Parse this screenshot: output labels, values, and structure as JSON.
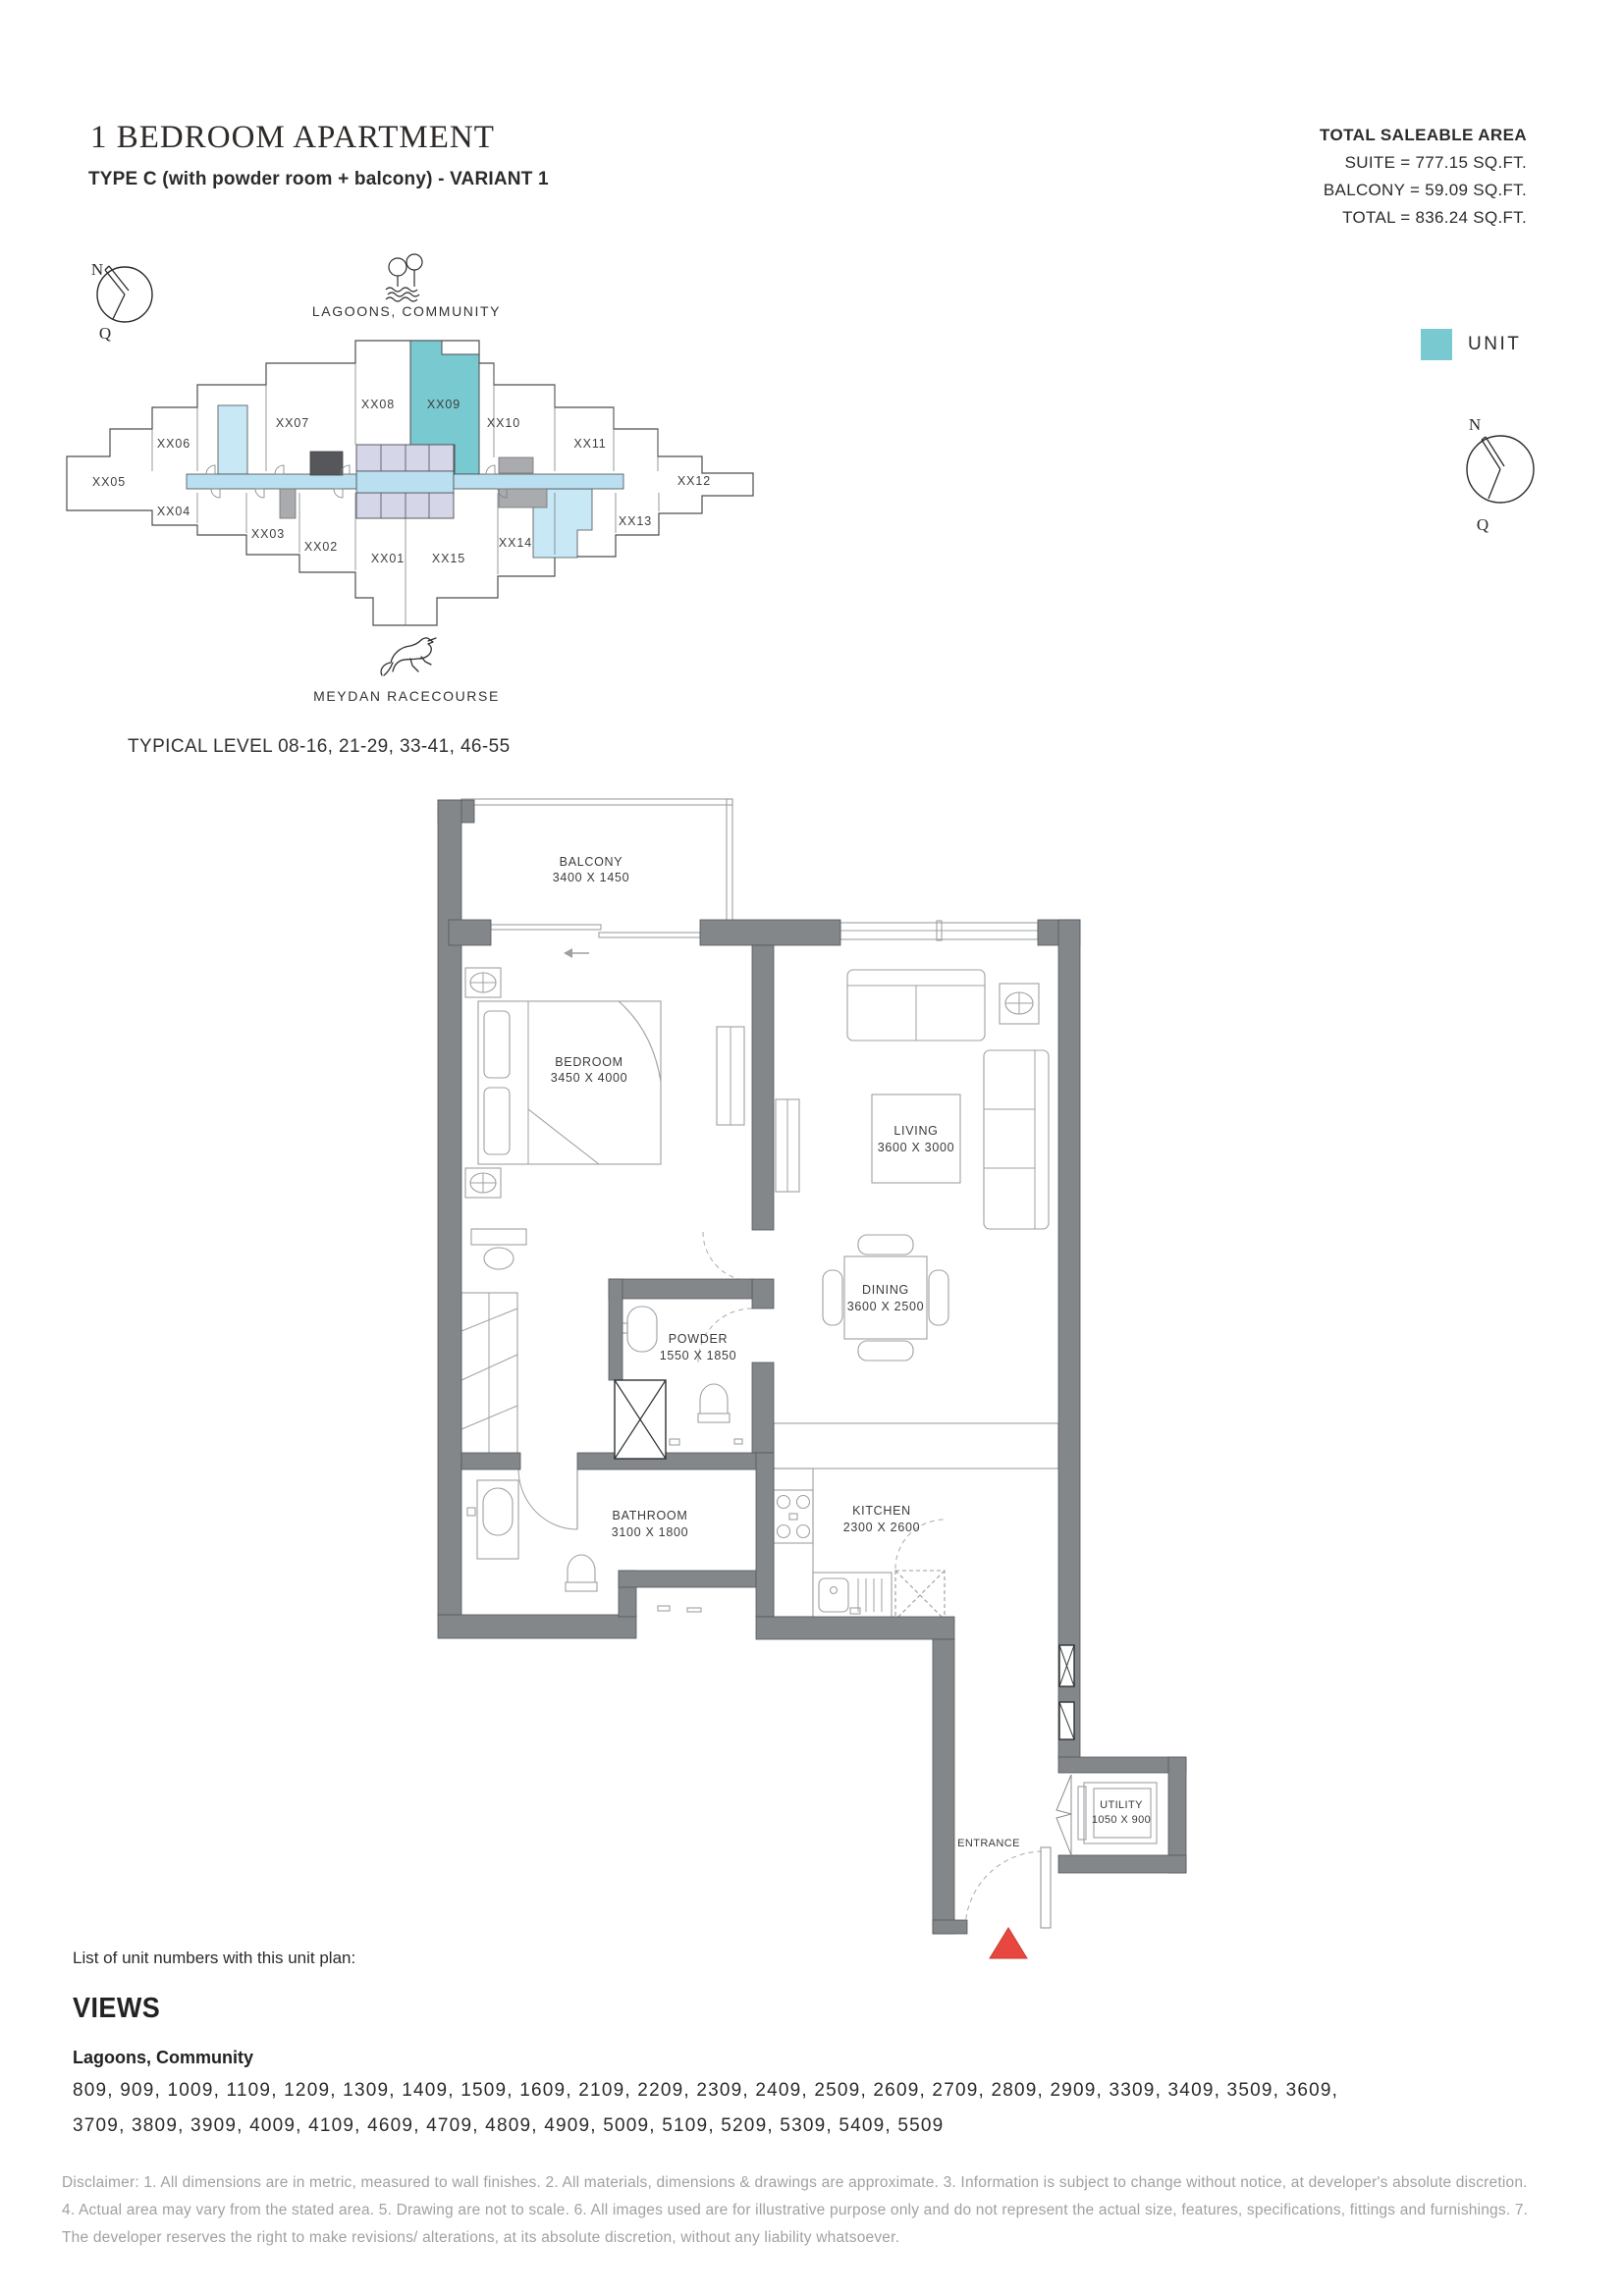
{
  "header": {
    "title": "1 BEDROOM APARTMENT",
    "subtitle": "TYPE C (with powder room + balcony) - VARIANT 1",
    "saleable_area": {
      "heading": "TOTAL SALEABLE AREA",
      "suite": "SUITE = 777.15 SQ.FT.",
      "balcony": "BALCONY = 59.09 SQ.FT.",
      "total": "TOTAL = 836.24 SQ.FT."
    }
  },
  "keyplan": {
    "compass_n": "N",
    "compass_q": "Q",
    "landmark_top": "LAGOONS, COMMUNITY",
    "landmark_bottom": "MEYDAN RACECOURSE",
    "typical_level": "TYPICAL LEVEL 08-16, 21-29, 33-41, 46-55",
    "highlighted_unit": "XX09",
    "units": [
      "XX01",
      "XX02",
      "XX03",
      "XX04",
      "XX05",
      "XX06",
      "XX07",
      "XX08",
      "XX09",
      "XX10",
      "XX11",
      "XX12",
      "XX13",
      "XX14",
      "XX15"
    ]
  },
  "legend": {
    "unit_label": "UNIT",
    "unit_color": "#79C9D1"
  },
  "floorplan": {
    "entrance_label": "ENTRANCE",
    "rooms": [
      {
        "name": "BALCONY",
        "dims": "3400 X 1450"
      },
      {
        "name": "BEDROOM",
        "dims": "3450 X 4000"
      },
      {
        "name": "LIVING",
        "dims": "3600 X 3000"
      },
      {
        "name": "DINING",
        "dims": "3600 X 2500"
      },
      {
        "name": "POWDER",
        "dims": "1550 X 1850"
      },
      {
        "name": "BATHROOM",
        "dims": "3100 X 1800"
      },
      {
        "name": "KITCHEN",
        "dims": "2300 X 2600"
      },
      {
        "name": "UTILITY",
        "dims": "1050 X 900"
      }
    ]
  },
  "footer": {
    "list_label": "List of unit numbers with this unit plan:",
    "views_title": "VIEWS",
    "views_subtitle": "Lagoons, Community",
    "unit_numbers": "809, 909, 1009, 1109, 1209, 1309, 1409, 1509, 1609, 2109, 2209, 2309, 2409, 2509, 2609, 2709, 2809, 2909, 3309, 3409, 3509, 3609, 3709, 3809, 3909, 4009, 4109, 4609, 4709, 4809, 4909, 5009, 5109, 5209, 5309, 5409, 5509",
    "disclaimer": "Disclaimer: 1. All dimensions are in metric, measured to wall finishes. 2. All materials, dimensions & drawings are approximate. 3. Information is subject to change without notice, at developer's absolute discretion. 4. Actual area may vary from the stated area. 5. Drawing are not to scale. 6. All images used are for illustrative purpose only and do not represent the actual size, features, specifications, fittings and furnishings. 7. The developer reserves the right to make revisions/ alterations, at its absolute discretion, without any liability whatsoever."
  },
  "colors": {
    "unit_highlight": "#79C9D1",
    "corridor_blue": "#BADFF0",
    "light_blue": "#C8E8F6",
    "lavender": "#D6D6E9",
    "wall_gray": "#84878A",
    "entrance_red": "#E8473F"
  }
}
